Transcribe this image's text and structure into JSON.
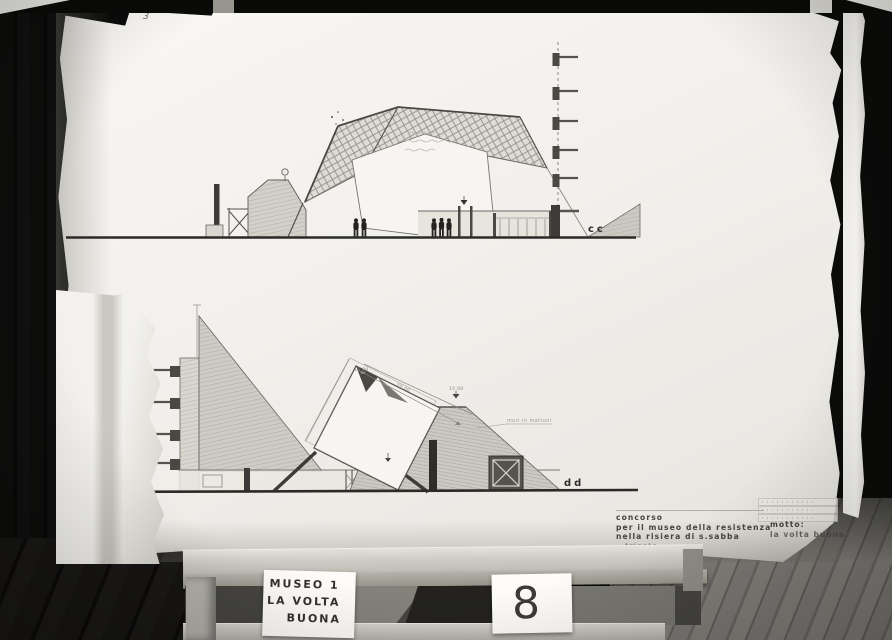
{
  "photo": {
    "pencil_mark": "3"
  },
  "drawing": {
    "section_top": {
      "label": "cc"
    },
    "section_bottom": {
      "label": "dd",
      "wall_note": "muri in mattoni",
      "dim_left": "15.90",
      "dim_mid": "20.00",
      "level_label": "15.00"
    },
    "title_block": {
      "line1": "concorso",
      "line2": "per il museo della resistenza",
      "line3": "nella risiera di s.sabba",
      "line4": "trieste",
      "motto_label": "motto:",
      "motto_value": "la volta buona"
    }
  },
  "easel": {
    "label_card_lines": [
      "MUSEO 1",
      "LA VOLTA",
      "BUONA"
    ],
    "number_card": "8"
  },
  "colors": {
    "paper": "#f4f2ee",
    "background": "#0b0b0a",
    "floor": "#74726d",
    "ink": "#3a3834"
  }
}
